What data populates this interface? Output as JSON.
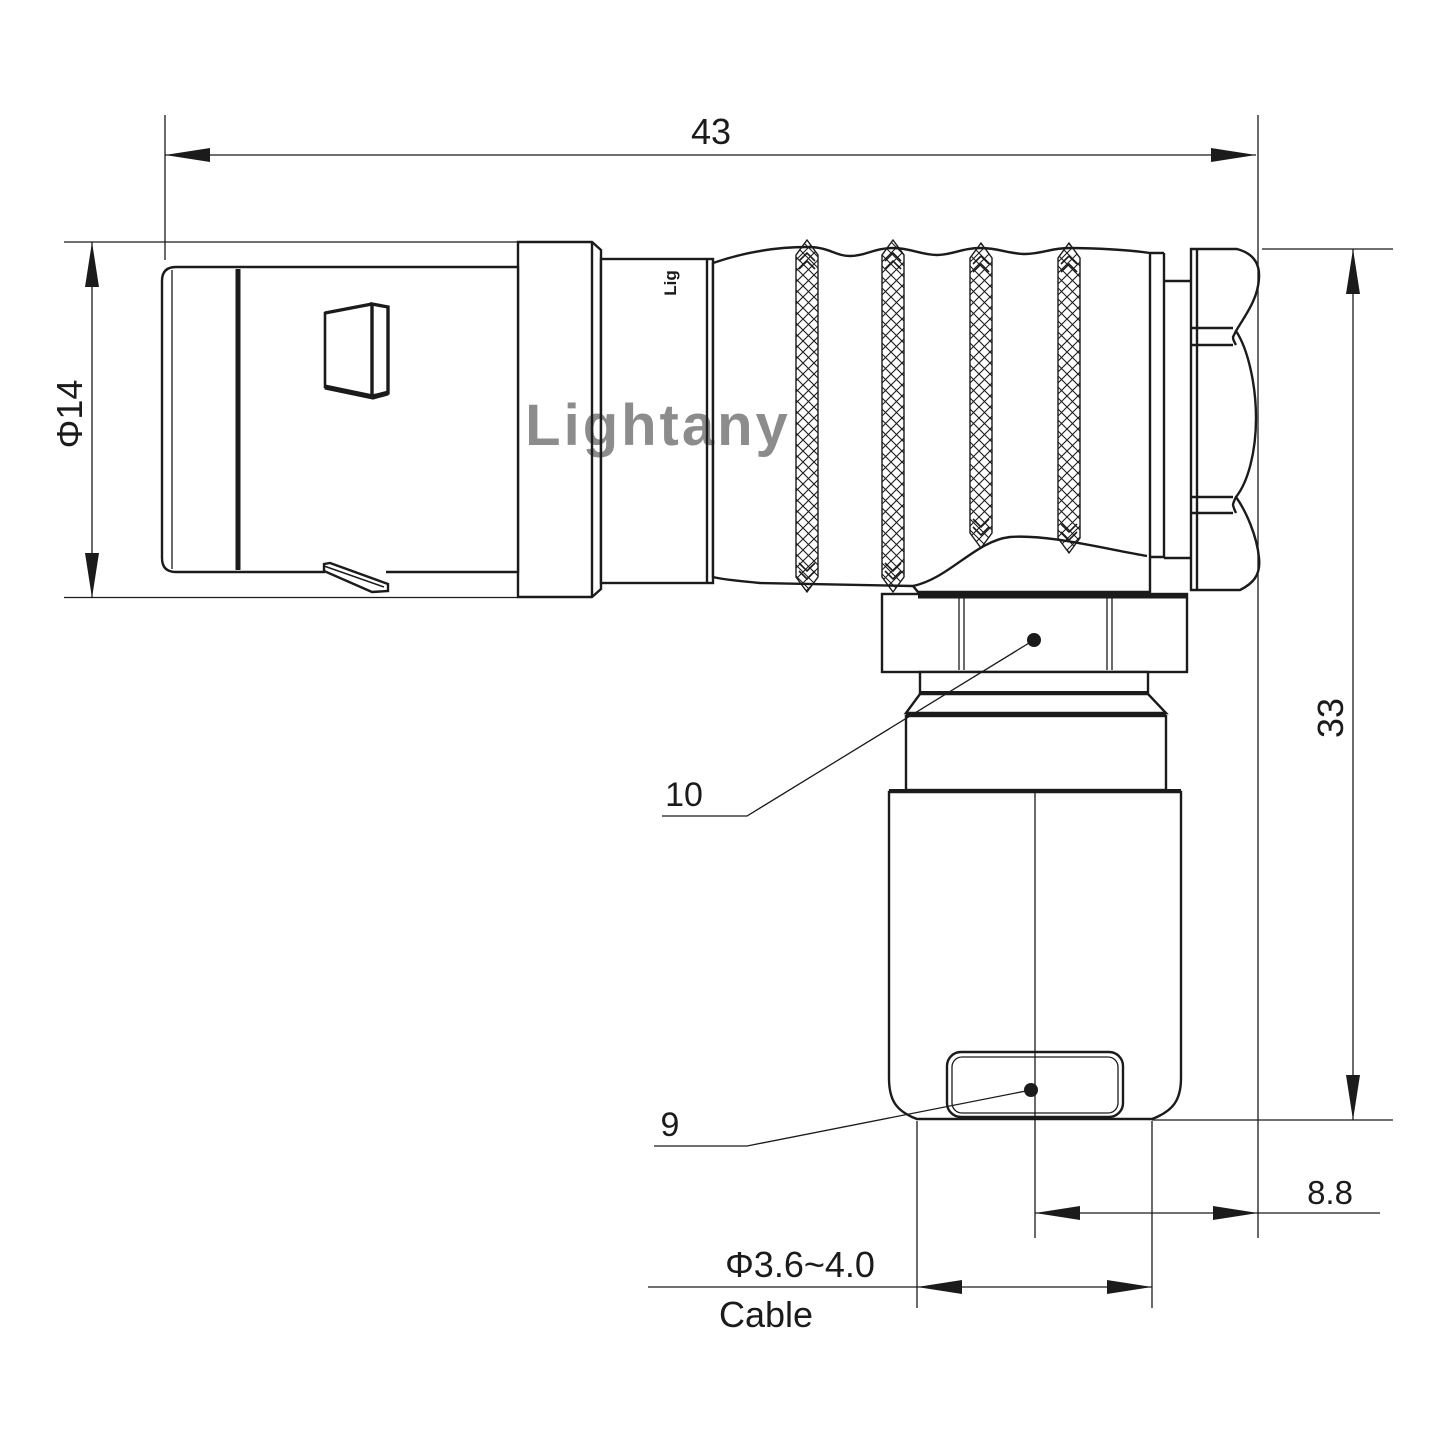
{
  "labels": {
    "overall_length": "43",
    "front_diameter": "Φ14",
    "height": "33",
    "rear_offset": "8.8",
    "cable_diameter": "Φ3.6~4.0",
    "cable": "Cable",
    "nut_callout": "10",
    "crimp_callout": "9",
    "watermark": "Lightany",
    "brand": "Lig"
  },
  "colors": {
    "line": "#1b1b1b",
    "watermark": "#f0b9b9",
    "background": "#ffffff"
  }
}
